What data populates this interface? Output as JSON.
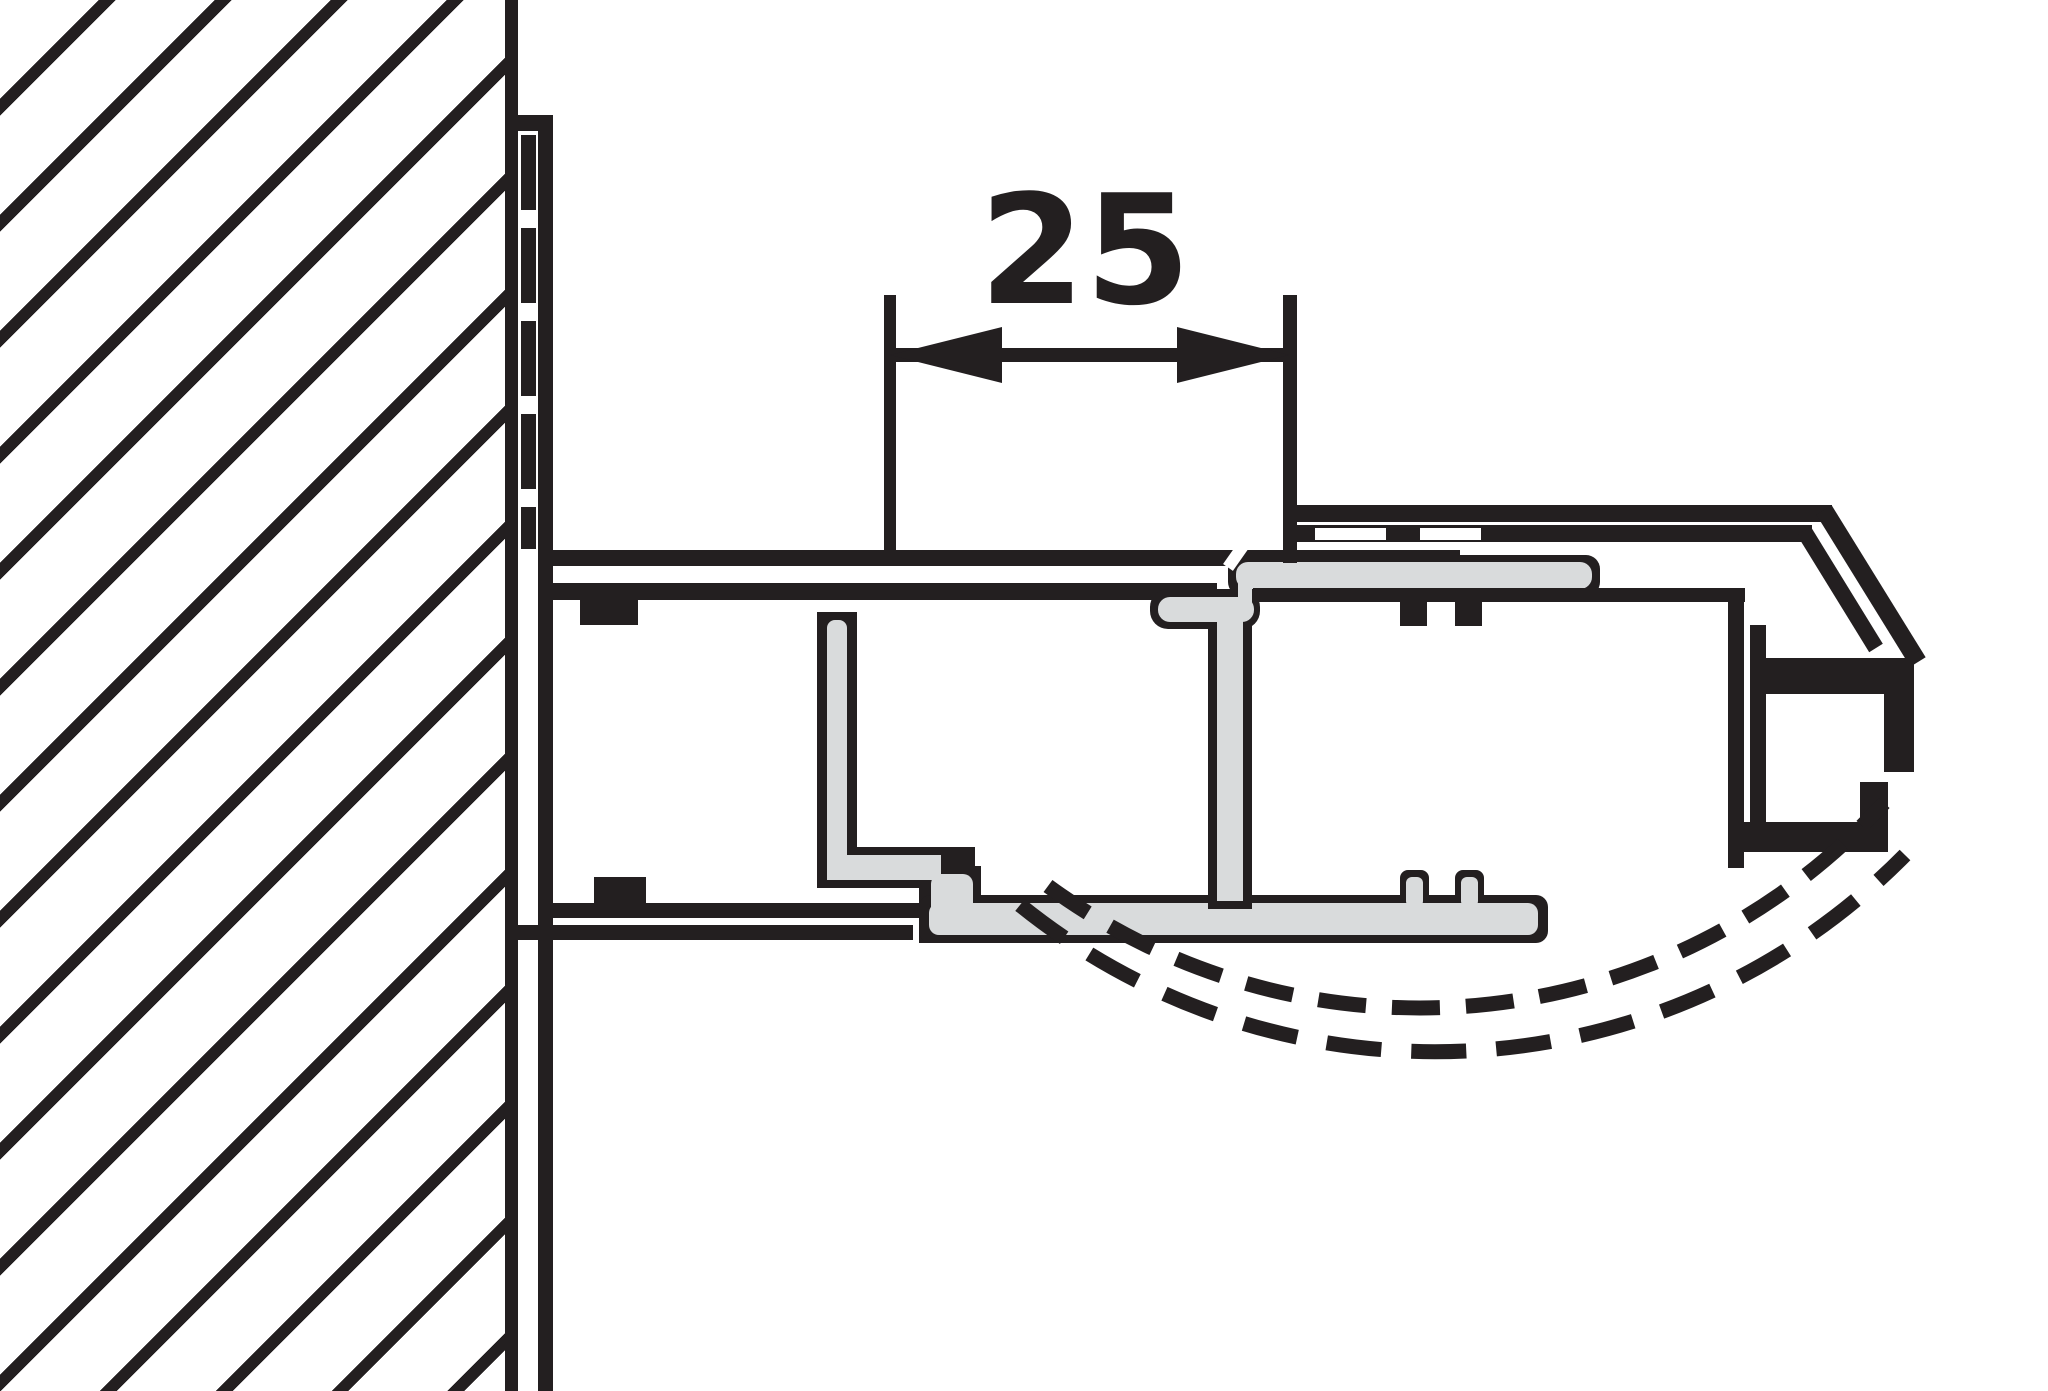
{
  "canvas": {
    "width": 2048,
    "height": 1391,
    "background": "#ffffff"
  },
  "colors": {
    "line": "#231f20",
    "seal_fill": "#d9dbdc",
    "background": "#ffffff"
  },
  "dimension": {
    "label": "25"
  }
}
